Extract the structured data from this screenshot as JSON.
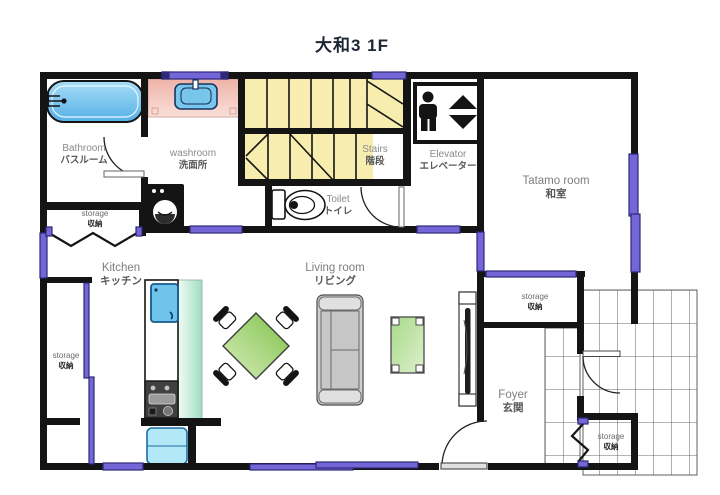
{
  "title": "大和3 1F",
  "rooms": {
    "bathroom": {
      "en": "Bathroom",
      "jp": "バスルーム"
    },
    "washroom": {
      "en": "washroom",
      "jp": "洗面所"
    },
    "stairs": {
      "en": "Stairs",
      "jp": "階段"
    },
    "toilet": {
      "en": "Toilet",
      "jp": "トイレ"
    },
    "elevator": {
      "en": "Elevator",
      "jp": "エレベーター"
    },
    "tatami": {
      "en": "Tatamo room",
      "jp": "和室"
    },
    "kitchen": {
      "en": "Kitchen",
      "jp": "キッチン"
    },
    "living": {
      "en": "Living room",
      "jp": "リビング"
    },
    "foyer": {
      "en": "Foyer",
      "jp": "玄関"
    },
    "storage_upper_left": {
      "en": "storage",
      "jp": "収納"
    },
    "storage_left": {
      "en": "storage",
      "jp": "収納"
    },
    "storage_foyer": {
      "en": "storage",
      "jp": "収納"
    },
    "storage_bottom_right": {
      "en": "storage",
      "jp": "収納"
    }
  },
  "colors": {
    "wall": "#141414",
    "window_fill": "#7566d8",
    "window_border": "#2d2878",
    "stairs_yellow": "#f6edae",
    "bathtub_blue": "#6fc2ec",
    "vanity_pink": "#f2c3ba",
    "sink_blue": "#79c6ec",
    "kitchen_counter_green": "#aee3cb",
    "fridge_blue": "#b3e8f8",
    "table_green": "#8ec958",
    "sofa_gray": "#cfcfcf",
    "tile_line": "#3a3a3a",
    "label_gray": "#8a8a8a",
    "title_color": "#1d2433"
  }
}
